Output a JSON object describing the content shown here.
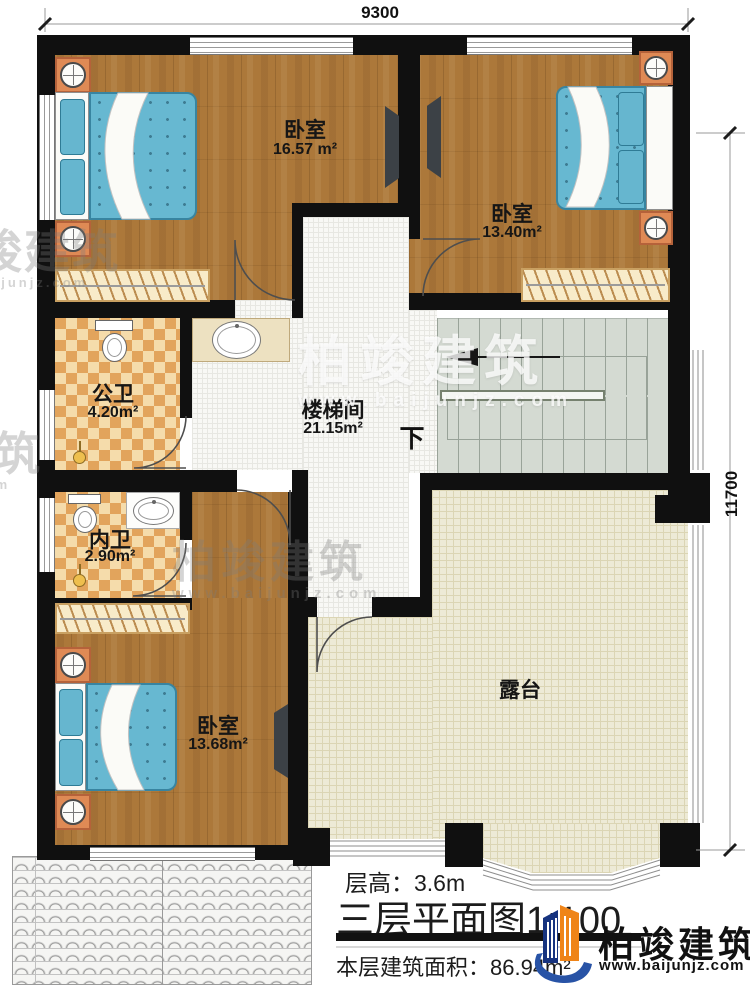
{
  "drawing": {
    "dimensions": {
      "width": "9300",
      "height": "11700"
    },
    "rooms": [
      {
        "label": "卧室",
        "area": "16.57 m²"
      },
      {
        "label": "卧室",
        "area": "13.40m²"
      },
      {
        "label": "公卫",
        "area": "4.20m²"
      },
      {
        "label": "楼梯间",
        "area": "21.15m²",
        "direction": "下"
      },
      {
        "label": "内卫",
        "area": "2.90m²"
      },
      {
        "label": "卧室",
        "area": "13.68m²"
      },
      {
        "label": "露台",
        "area": ""
      }
    ]
  },
  "title_block": {
    "floor_height": "层高：3.6m",
    "plan_title": "三层平面图",
    "scale": "1:100",
    "floor_area": "本层建筑面积：86.94m²"
  },
  "branding": {
    "company": "柏竣建筑",
    "website": "www.baijunjz.com"
  },
  "colors": {
    "wall": "#101010",
    "wood_floor": "#ac783a",
    "bed": "#67b8d1",
    "bath_tile": "#e2a45c",
    "stairs": "#d4dad2",
    "terrace": "#edead6",
    "logo_blue": "#16337f",
    "logo_orange": "#ef8418"
  }
}
